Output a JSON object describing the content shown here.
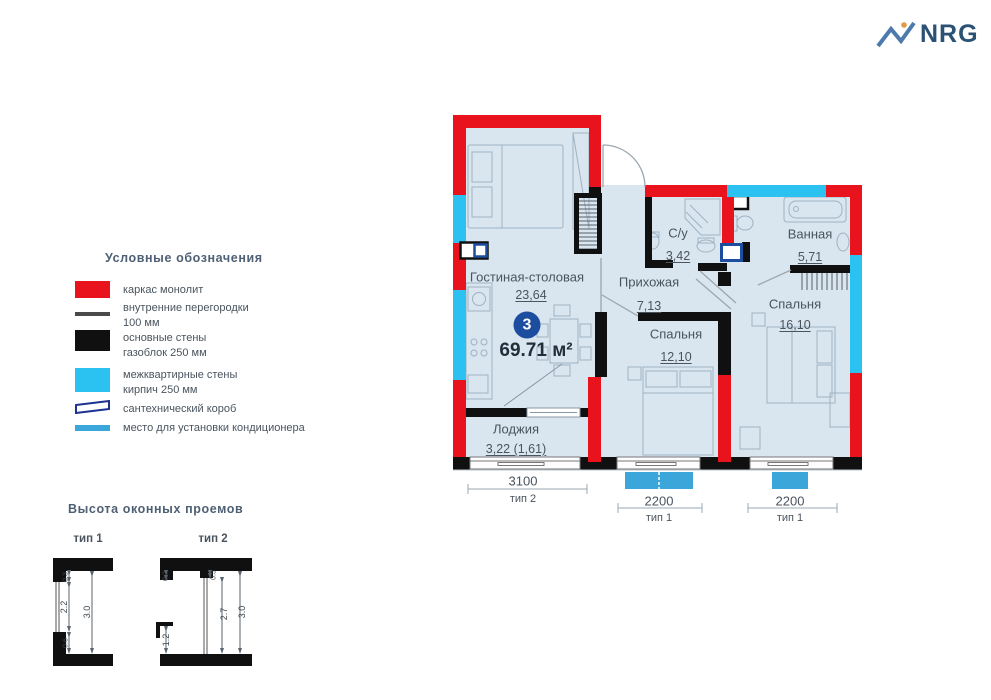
{
  "logo": {
    "text": "NRG"
  },
  "legend": {
    "title": "Условные обозначения",
    "items": [
      {
        "line1": "каркас монолит",
        "line2": ""
      },
      {
        "line1": "внутренние перегородки",
        "line2": "100 мм"
      },
      {
        "line1": "основные стены",
        "line2": "газоблок 250 мм"
      },
      {
        "line1": "межквартирные стены",
        "line2": "кирпич 250 мм"
      },
      {
        "line1": "сантехнический короб",
        "line2": ""
      },
      {
        "line1": "место для установки кондиционера",
        "line2": ""
      }
    ]
  },
  "window_heights": {
    "title": "Высота оконных проемов",
    "type1": {
      "label": "тип 1",
      "dim_top": "0.3",
      "dim_window": "2.2",
      "dim_bottom": "0.6",
      "dim_total": "3.0"
    },
    "type2": {
      "label": "тип 2",
      "dim_top_left": "0.2",
      "dim_top_mid": "0.3",
      "dim_low": "1.2",
      "dim_window": "2.7",
      "dim_total": "3.0"
    }
  },
  "plan": {
    "number_badge": "3",
    "total_area": "69.71 м²",
    "rooms": [
      {
        "name": "Гостиная-столовая",
        "area": "23,64"
      },
      {
        "name": "Прихожая",
        "area": "7,13"
      },
      {
        "name": "С/у",
        "area": "3,42"
      },
      {
        "name": "Ванная",
        "area": "5,71"
      },
      {
        "name": "Спальня",
        "area": "16,10"
      },
      {
        "name": "Спальня",
        "area": "12,10"
      },
      {
        "name": "Лоджия",
        "area": "3,22 (1,61)"
      }
    ],
    "window_dims": [
      {
        "width": "3100",
        "type": "тип 2"
      },
      {
        "width": "2200",
        "type": "тип 1"
      },
      {
        "width": "2200",
        "type": "тип 1"
      }
    ]
  },
  "colors": {
    "monolith_red": "#e8131c",
    "interapartment_cyan": "#2bc2f1",
    "main_wall_black": "#101010",
    "partition_gray": "#4a4a4a",
    "floor_fill": "#d9e5ef",
    "badge_navy": "#1c4d9e",
    "sanitary_navy": "#1d3190",
    "ac_blue": "#3aa6da",
    "logo_blue": "#2b5174"
  }
}
